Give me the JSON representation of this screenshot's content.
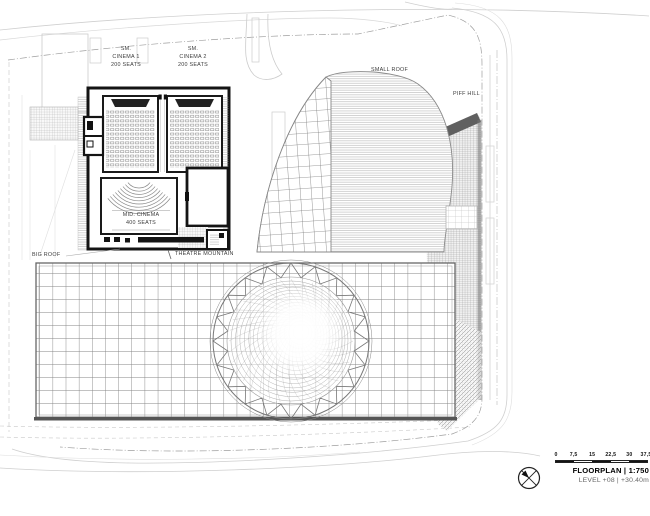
{
  "plan": {
    "labels": {
      "cinema1": "SM.\nCINEMA 1\n200 SEATS",
      "cinema2": "SM.\nCINEMA 2\n200 SEATS",
      "mid_cinema": "MID. CINEMA\n400 SEATS",
      "small_roof": "SMALL ROOF",
      "piff_hill": "PIFF HILL",
      "big_roof": "BIG ROOF",
      "theatre_mountain": "THEATRE MOUNTAIN"
    },
    "colors": {
      "wall": "#141414",
      "hatch": "#8d8d8d",
      "grid": "#858585",
      "boundary": "#9f9f9f",
      "background": "#ffffff"
    }
  },
  "legend": {
    "compass_icon": "north-arrow",
    "scale_ticks": [
      "0",
      "7,5",
      "15",
      "22,5",
      "30",
      "37,5"
    ],
    "title": "FLOORPLAN | 1:750",
    "subtitle": "LEVEL +08 | +30.40m"
  }
}
